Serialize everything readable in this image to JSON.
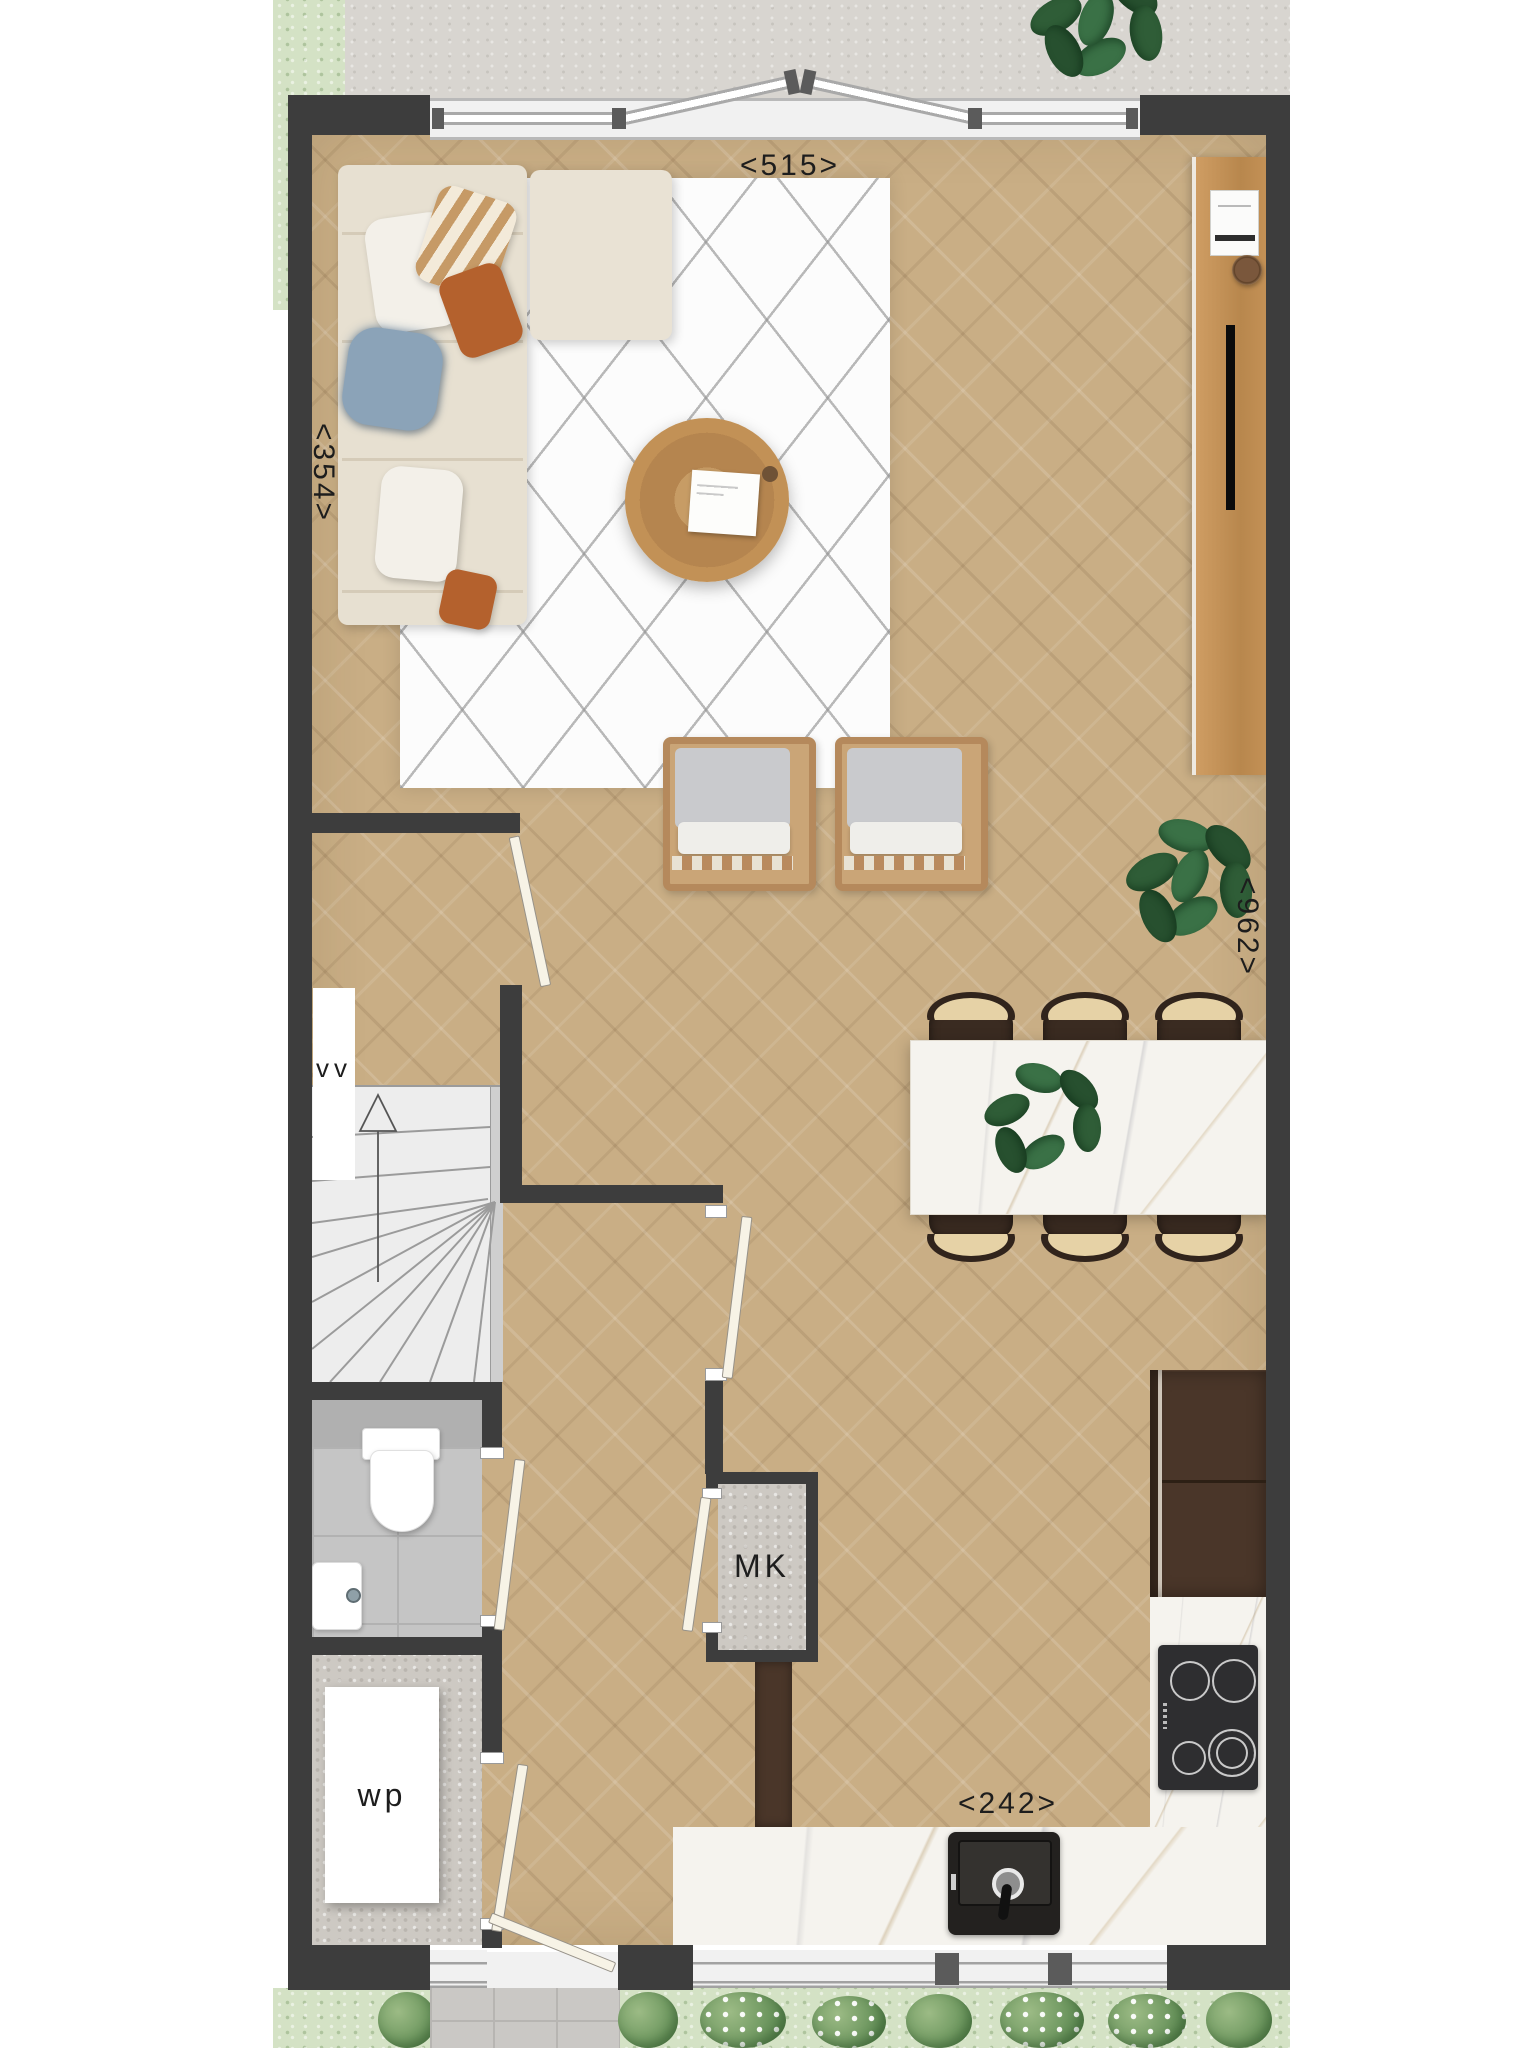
{
  "plan": {
    "dimensions": {
      "top_width": "<515>",
      "left_height": "<354>",
      "right_height": "<962>",
      "kitchen_width": "<242>"
    },
    "labels": {
      "void": "vv",
      "meter_cupboard": "MK",
      "heat_pump": "wp"
    },
    "colors": {
      "wall": "#3d3d3d",
      "wood_floor": "#c9ae85",
      "rug": "#fcfcfc",
      "marble_counter": "#f5f3ee",
      "cabinet_dark": "#4a3629",
      "sofa_cream": "#e7e0d1",
      "accent_rust": "#b4612d",
      "accent_blue": "#8ba3b8",
      "plant_green": "#2f5d37",
      "grass": "#d4e2c5",
      "terrace": "#d8d5d0",
      "tile_gray": "#c5c5c5"
    }
  }
}
